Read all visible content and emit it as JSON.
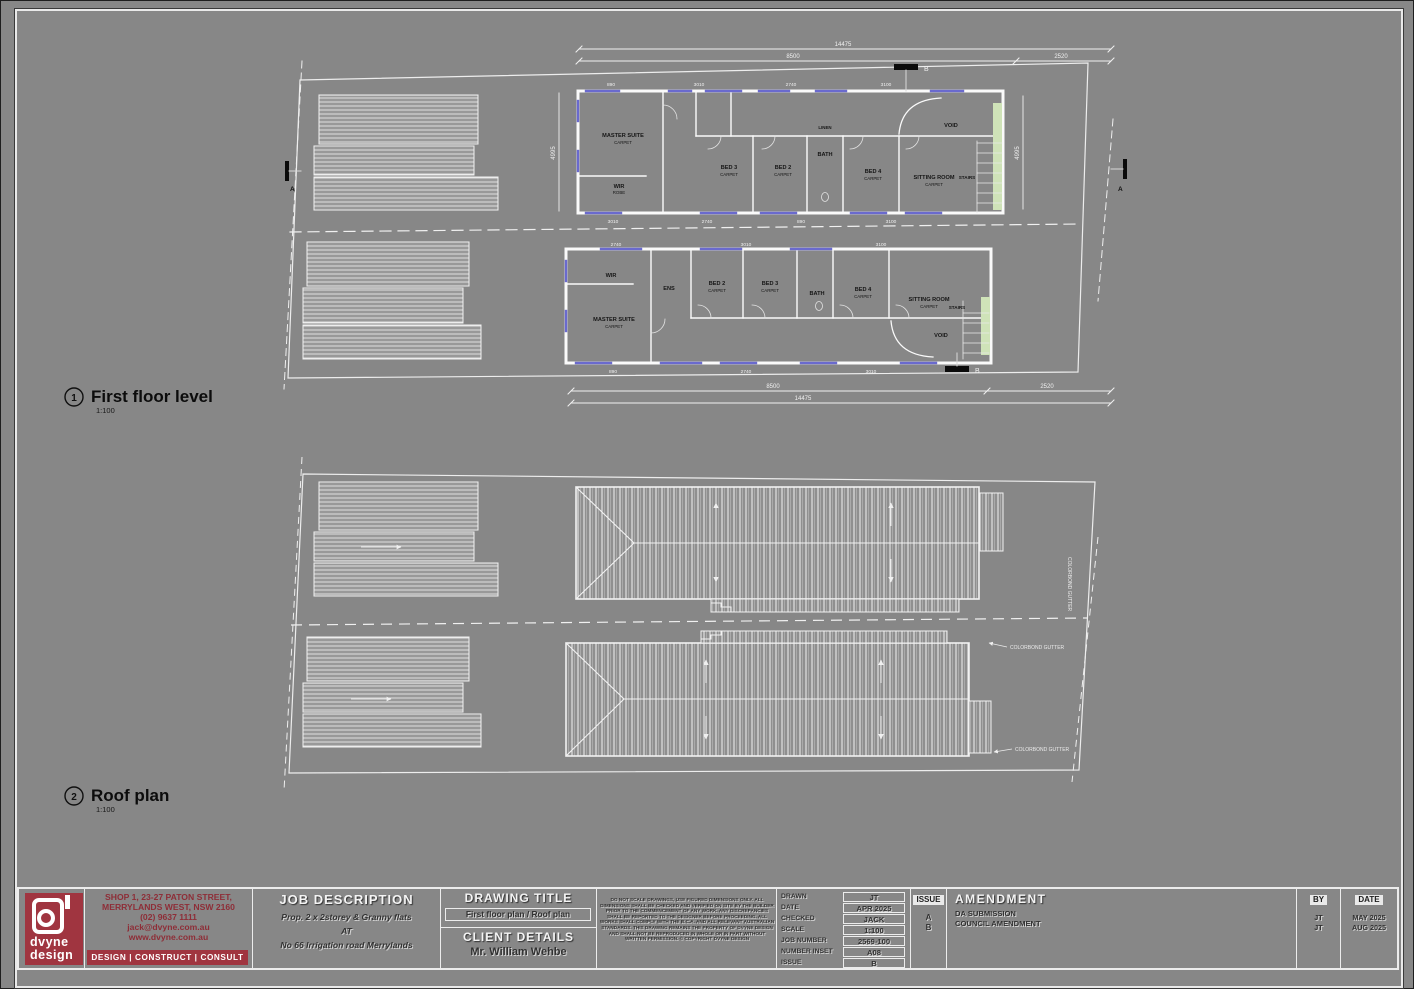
{
  "sheet": {
    "bg": "#878787",
    "brand_red": "#a03540",
    "stair_green": "#cfe3b8",
    "window_blue": "#6a6ace"
  },
  "plan1": {
    "bubble": "1",
    "title": "First floor level",
    "scale": "1:100",
    "marker_a": "A",
    "marker_b": "B",
    "dims": {
      "top_total": "14475",
      "top_main": "8500",
      "top_right": "2520",
      "bottom_main": "8500",
      "bottom_right": "2520",
      "bottom_total": "14475",
      "left": "4995",
      "right": "4995"
    },
    "small_dims": [
      "890",
      "3010",
      "2740",
      "3100",
      "600",
      "1210"
    ],
    "upper": {
      "rooms": {
        "master": "MASTER SUITE",
        "master_sub": "CARPET",
        "wir": "WIR",
        "wir_sub": "ROBE",
        "bed3": "BED 3",
        "bed3_sub": "CARPET",
        "bed2": "BED 2",
        "bed2_sub": "CARPET",
        "bath": "BATH",
        "linen": "LINEN",
        "bed4": "BED 4",
        "bed4_sub": "CARPET",
        "sitting": "SITTING ROOM",
        "sitting_sub": "CARPET",
        "void": "VOID",
        "stairs": "STAIRS"
      }
    },
    "lower": {
      "rooms": {
        "wir": "WIR",
        "ens": "ENS",
        "master": "MASTER SUITE",
        "master_sub": "CARPET",
        "bed2": "BED 2",
        "bed2_sub": "CARPET",
        "bed3": "BED 3",
        "bed3_sub": "CARPET",
        "bath": "BATH",
        "bed4": "BED 4",
        "bed4_sub": "CARPET",
        "sitting": "SITTING ROOM",
        "sitting_sub": "CARPET",
        "void": "VOID",
        "stairs": "STAIRS"
      }
    }
  },
  "plan2": {
    "bubble": "2",
    "title": "Roof plan",
    "scale": "1:100",
    "ann_gutter1": "COLORBOND GUTTER",
    "ann_gutter2": "COLORBOND GUTTER"
  },
  "titleblock": {
    "logo": {
      "line1": "dvyne",
      "line2": "design"
    },
    "contact": {
      "line1": "SHOP 1, 23-27 PATON STREET,",
      "line2": "MERRYLANDS WEST, NSW 2160",
      "line3": "(02) 9637 1111",
      "line4": "jack@dvyne.com.au",
      "line5": "www.dvyne.com.au",
      "tagline": "DESIGN |  CONSTRUCT  | CONSULT"
    },
    "job": {
      "header": "JOB DESCRIPTION",
      "line1": "Prop. 2 x 2storey & Granny flats",
      "line2": "AT",
      "line3": "No 66 Irrigation road Merrylands"
    },
    "drawing": {
      "header": "DRAWING TITLE",
      "title": "First floor plan / Roof plan"
    },
    "client": {
      "header": "CLIENT DETAILS",
      "name": "Mr. William Wehbe"
    },
    "disclaimer": "DO NOT SCALE DRAWINGS, USE FIGURED DIMENSIONS ONLY. ALL DIMENSIONS SHALL BE CHECKED AND VERIFIED ON SITE BY THE BUILDER PRIOR TO THE COMMENCEMENT OF ANY WORK. ANY DISCREPANCIES SHALL BE REPORTED TO THE DESIGNER BEFORE PROCEEDING. ALL WORKS SHALL COMPLY WITH THE B.C.A. AND ALL RELEVANT AUSTRALIAN STANDARDS. THIS DRAWING REMAINS THE PROPERTY OF DVYNE DESIGN AND SHALL NOT BE REPRODUCED IN WHOLE OR IN PART WITHOUT WRITTEN PERMISSION. © COPYRIGHT DVYNE DESIGN",
    "meta": {
      "rows": [
        {
          "label": "DRAWN",
          "value": "JT"
        },
        {
          "label": "DATE",
          "value": "APR 2025"
        },
        {
          "label": "CHECKED",
          "value": "JACK"
        },
        {
          "label": "SCALE",
          "value": "1:100"
        },
        {
          "label": "JOB NUMBER",
          "value": "2569-100"
        },
        {
          "label": "NUMBER INSET",
          "value": "A08"
        },
        {
          "label": "ISSUE",
          "value": "B"
        }
      ]
    },
    "amendment": {
      "issue_header": "ISSUE",
      "header": "AMENDMENT",
      "by_header": "BY",
      "date_header": "DATE",
      "rows": [
        {
          "issue": "A",
          "desc": "DA SUBMISSION",
          "by": "JT",
          "date": "MAY 2025"
        },
        {
          "issue": "B",
          "desc": "COUNCIL AMENDMENT",
          "by": "JT",
          "date": "AUG 2025"
        }
      ]
    }
  }
}
